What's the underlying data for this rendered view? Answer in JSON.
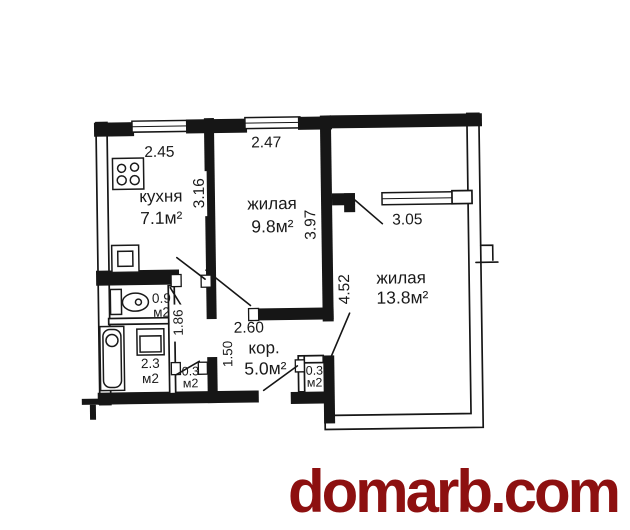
{
  "watermark": {
    "text": "domarb.com",
    "color": "#8d1010"
  },
  "plan": {
    "rooms": {
      "kitchen": {
        "label": "кухня",
        "area": "7.1м²",
        "width_m": "2.45",
        "depth_m": "3.16"
      },
      "living_small": {
        "label": "жилая",
        "area": "9.8м²",
        "width_m": "2.47",
        "depth_m": "3.97"
      },
      "living_large": {
        "label": "жилая",
        "area": "13.8м²",
        "depth_m": "4.52",
        "window_width_m": "3.05"
      },
      "corridor": {
        "label": "кор.",
        "area": "5.0м²",
        "width_m": "2.60",
        "passage_m": "1.50"
      },
      "wc": {
        "area": "0.9",
        "unit": "м2",
        "depth_m": "1.86"
      },
      "bathroom": {
        "area": "2.3",
        "unit": "м2"
      },
      "closet_left": {
        "area": "0.3",
        "unit": "м2"
      },
      "closet_right": {
        "area": "0.3",
        "unit": "м2"
      }
    }
  }
}
